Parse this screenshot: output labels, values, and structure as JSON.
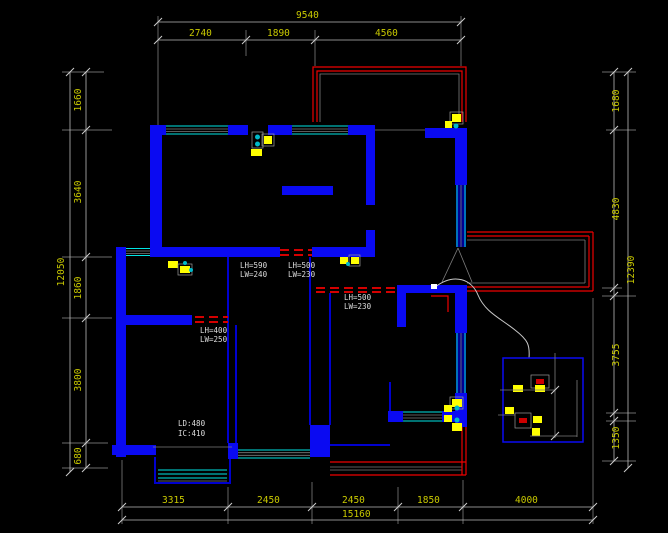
{
  "drawing": {
    "type": "cad-floor-plan",
    "background": "#000000",
    "colors": {
      "wall_blue": "#0a0af2",
      "window_cyan": "#00e5e5",
      "balcony_red": "#ee0000",
      "dimension_text_yellow": "#c9c900",
      "dimension_line_gray": "#b9b9b9",
      "annotation_white": "#dedede",
      "symbol_yellow": "#ffff00"
    }
  },
  "dimensions": {
    "top": {
      "total": "9540",
      "segments": [
        "2740",
        "1890",
        "4560"
      ]
    },
    "left": {
      "total": "12050",
      "segments": [
        "1660",
        "3640",
        "1860",
        "3800",
        "680"
      ]
    },
    "right": {
      "total": "12390",
      "segments": [
        "1680",
        "4830",
        "3755",
        "1350"
      ]
    },
    "bottom": {
      "total": "15160",
      "segments": [
        "3315",
        "2450",
        "2450",
        "1850",
        "4000"
      ]
    }
  },
  "annotations": {
    "a1": {
      "line1": "LH=590",
      "line2": "LW=240"
    },
    "a2": {
      "line1": "LH=500",
      "line2": "LW=230"
    },
    "a3": {
      "line1": "LH=500",
      "line2": "LW=230"
    },
    "a4": {
      "line1": "LH=400",
      "line2": "LW=250"
    },
    "a5": {
      "line1": "LD:480",
      "line2": "IC:410"
    }
  }
}
